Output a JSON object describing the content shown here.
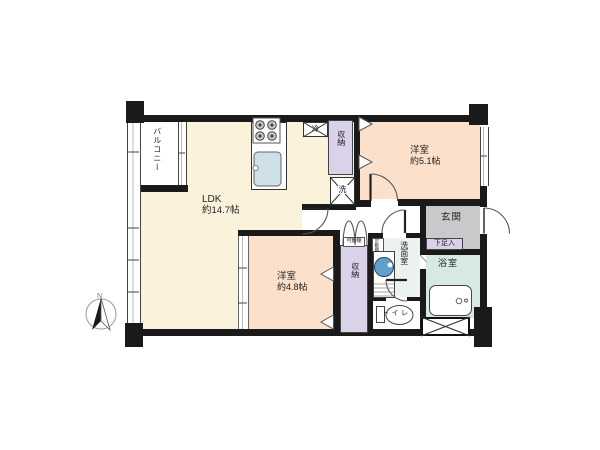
{
  "compass": {
    "north_label": "N"
  },
  "rooms": {
    "balcony": {
      "label": "バルコニー"
    },
    "ldk": {
      "name": "LDK",
      "size": "約14.7帖"
    },
    "bedroom1": {
      "name": "洋室",
      "size": "約5.1帖"
    },
    "bedroom2": {
      "name": "洋室",
      "size": "約4.8帖"
    },
    "entrance": {
      "label": "玄関"
    },
    "bath": {
      "label": "浴室"
    },
    "washroom": {
      "label": "洗面室"
    },
    "toilet": {
      "label": "トイレ"
    }
  },
  "fixtures": {
    "closet_upper": {
      "label": "収納"
    },
    "closet_lower": {
      "label": "収納"
    },
    "refrigerator": {
      "label": "冷"
    },
    "washer": {
      "label": "洗"
    },
    "shelf_upper": {
      "label": "可動棚"
    },
    "shelf_side": {
      "label": "可動棚"
    },
    "shoe_cabinet": {
      "label": "下足入"
    }
  },
  "colors": {
    "ldk_floor": "#FAF2DA",
    "bedroom_floor": "#FBE0CB",
    "closet": "#D9D2E9",
    "bathroom": "#D7E9E5",
    "washroom": "#EBF2EF",
    "entrance_floor": "#C9C9CB",
    "wall": "#1A1A1A",
    "basin": "#5FA0CF",
    "sink": "#CDDFE7"
  }
}
